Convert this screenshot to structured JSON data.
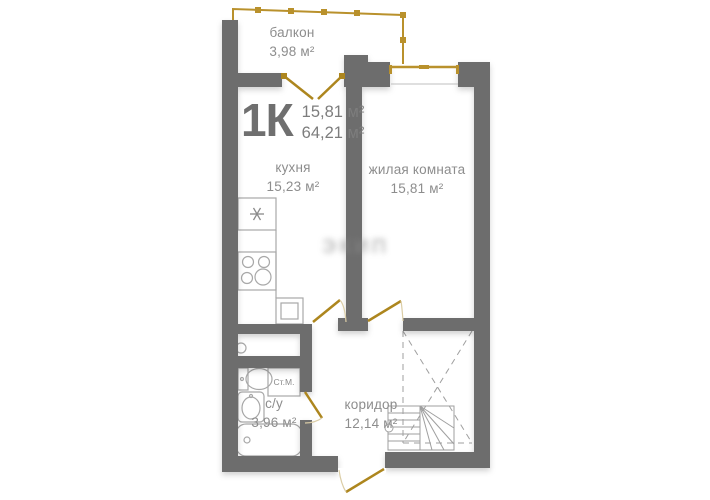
{
  "title": {
    "type": "1К",
    "living_area": "15,81 м²",
    "total_area": "64,21 м²"
  },
  "rooms": [
    {
      "id": "balcony",
      "name": "балкон",
      "area": "3,98 м²"
    },
    {
      "id": "kitchen",
      "name": "кухня",
      "area": "15,23 м²"
    },
    {
      "id": "living-room",
      "name": "жилая комната",
      "area": "15,81 м²"
    },
    {
      "id": "bathroom",
      "name": "с/у",
      "area": "3,96 м²"
    },
    {
      "id": "corridor",
      "name": "коридор",
      "area": "12,14 м²"
    }
  ],
  "fixtures": {
    "washing_machine_label": "Ст.М."
  },
  "watermark": "ЭКИП",
  "colors": {
    "wall_gray": "#6d6d6d",
    "gold": "#b9912c",
    "door_gold": "#ad861e",
    "fixture_gray": "#a8a8a8",
    "label_gray": "#8d8d8d"
  }
}
